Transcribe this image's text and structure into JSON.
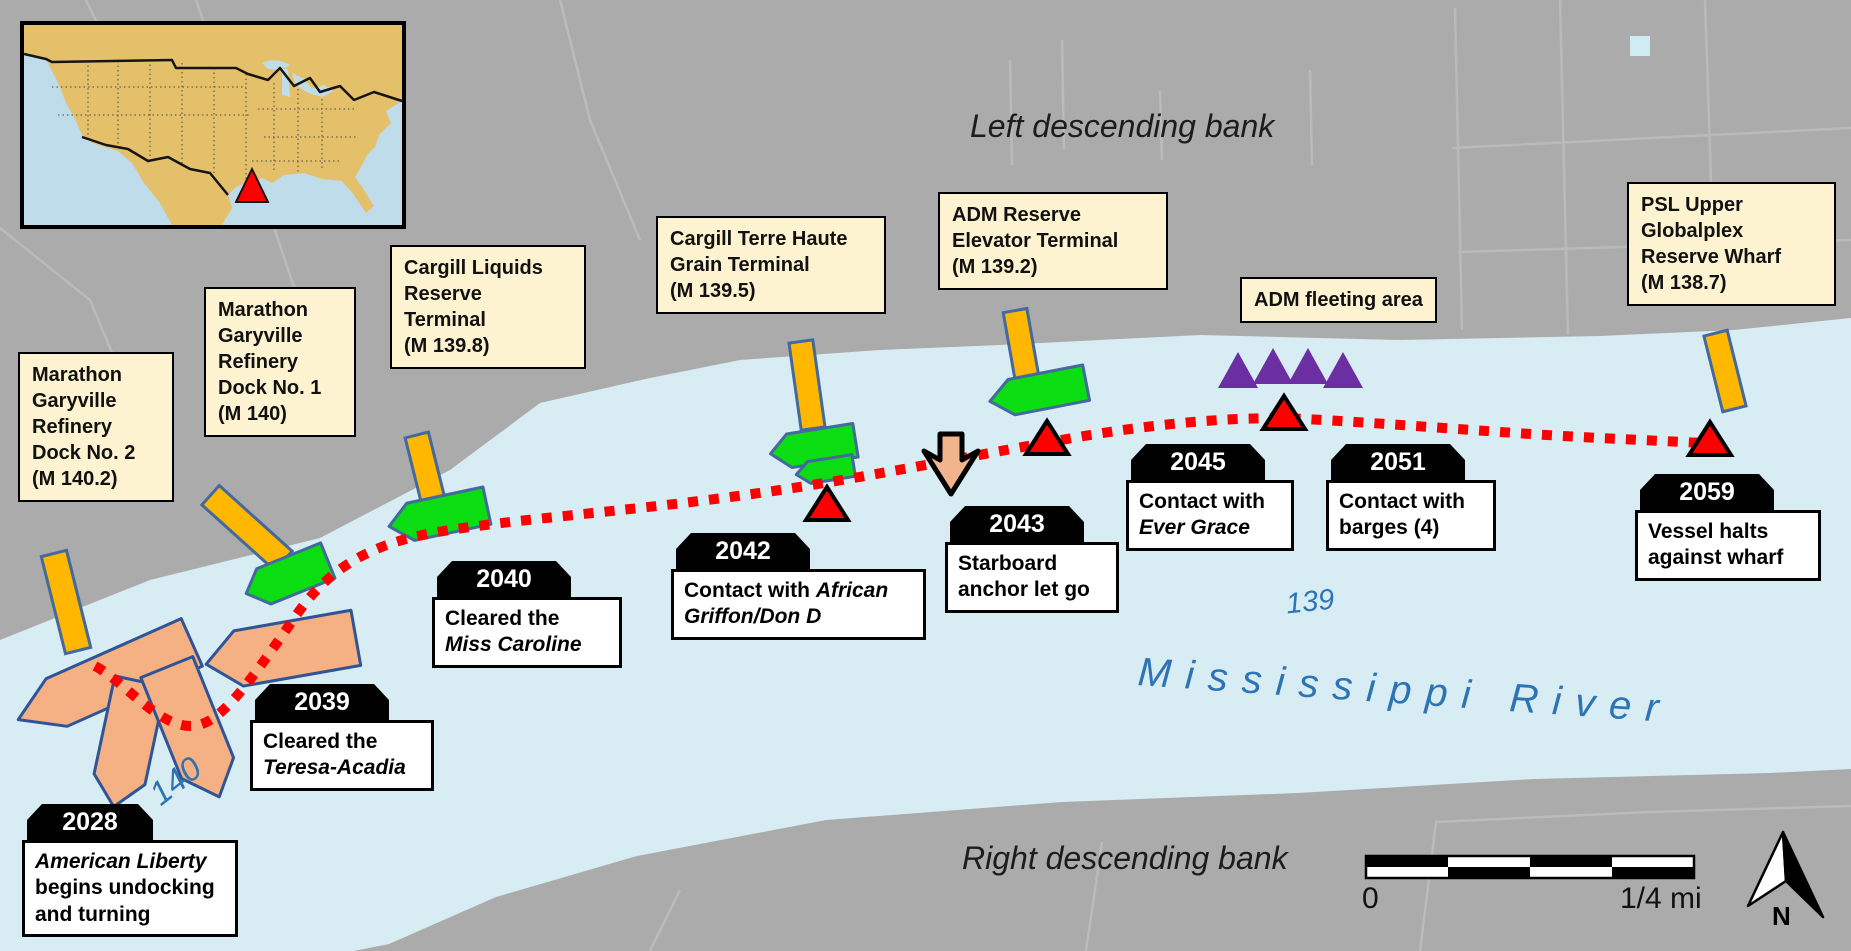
{
  "banks": {
    "left": "Left descending bank",
    "right": "Right descending bank"
  },
  "river": {
    "name": "M i s s i s s i p p i   R i v e r",
    "display_name": "Mississippi River",
    "mile_140": "140",
    "mile_139": "139"
  },
  "terminals": [
    {
      "label": "Marathon\nGaryville\nRefinery\nDock No. 2\n(M 140.2)"
    },
    {
      "label": "Marathon\nGaryville\nRefinery\nDock No. 1\n(M 140)"
    },
    {
      "label": "Cargill Liquids\nReserve\nTerminal\n(M 139.8)"
    },
    {
      "label": "Cargill Terre Haute\nGrain Terminal\n(M 139.5)"
    },
    {
      "label": "ADM Reserve\nElevator Terminal\n(M 139.2)"
    },
    {
      "label": "ADM fleeting area"
    },
    {
      "label": "PSL Upper\nGlobalplex\nReserve Wharf\n(M 138.7)"
    }
  ],
  "events": [
    {
      "time": "2028",
      "pre": "",
      "vessel": "American Liberty",
      "post": "\nbegins undocking\nand turning"
    },
    {
      "time": "2039",
      "pre": "Cleared the\n",
      "vessel": "Teresa-Acadia",
      "post": ""
    },
    {
      "time": "2040",
      "pre": "Cleared the\n",
      "vessel": "Miss Caroline",
      "post": ""
    },
    {
      "time": "2042",
      "pre": "Contact with ",
      "vessel": "African\nGriffon/Don D",
      "post": ""
    },
    {
      "time": "2043",
      "pre": "Starboard\nanchor let go",
      "vessel": "",
      "post": ""
    },
    {
      "time": "2045",
      "pre": "Contact with\n",
      "vessel": "Ever Grace",
      "post": ""
    },
    {
      "time": "2051",
      "pre": "Contact with\nbarges (4)",
      "vessel": "",
      "post": ""
    },
    {
      "time": "2059",
      "pre": "Vessel halts\nagainst wharf",
      "vessel": "",
      "post": ""
    }
  ],
  "scale_bar": {
    "start": "0",
    "end": "1/4 mi"
  },
  "compass": {
    "label": "N"
  },
  "colors": {
    "water": "#D8EDF3",
    "land": "#ABABAB",
    "terminal_label_bg": "#FDF3D0",
    "dock_yellow": "#FFB700",
    "moored_vessel_green": "#0ADD12",
    "vessel_peach": "#F5B183",
    "barge_purple": "#6B2FA3",
    "track_red": "#FF0000",
    "map_text_blue": "#2E74B5"
  }
}
